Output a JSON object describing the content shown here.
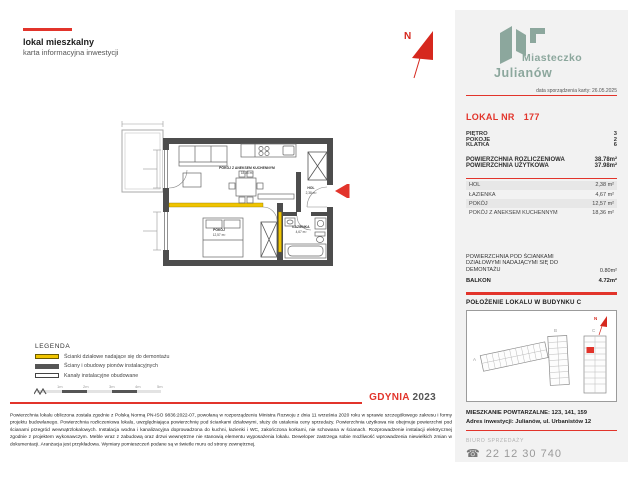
{
  "colors": {
    "accent_red": "#e2342b",
    "logo_green": "#8ca79d",
    "demountable_yellow": "#f0c400",
    "wall_gray": "#4d4d4d",
    "panel_bg": "#f2f2f2"
  },
  "header": {
    "title": "lokal mieszkalny",
    "subtitle": "karta informacyjna inwestycji"
  },
  "compass": {
    "n": "N"
  },
  "plan": {
    "rooms": {
      "living": {
        "name": "POKÓJ Z ANEKSEM KUCHENNYM",
        "area": "18,36 m²"
      },
      "hall": {
        "name": "HOL",
        "area": "2,38 m²"
      },
      "bedroom": {
        "name": "POKÓJ",
        "area": "12,57 m²"
      },
      "bathroom": {
        "name": "ŁAZIENKA",
        "area": "4,67 m²"
      }
    }
  },
  "legend": {
    "title": "LEGENDA",
    "items": [
      {
        "label": "Ścianki działowe nadające się do demontażu",
        "swatch": "#f0c400"
      },
      {
        "label": "Ściany i obudowy pionów instalacyjnych",
        "swatch": "#555555"
      },
      {
        "label": "Kanały instalacyjne obudowane",
        "swatch": "#ffffff"
      }
    ],
    "scale_ticks": [
      "1m",
      "2m",
      "3m",
      "4m",
      "5m"
    ]
  },
  "footer_left": {
    "city": "GDYNIA",
    "year": "2023",
    "disclaimer": "Powierzchnia lokalu obliczona została zgodnie z Polską Normą PN-ISO 9836:2022-07, powołaną w rozporządzeniu Ministra Rozwoju z dnia 11 września 2020 roku w sprawie szczegółowego zakresu i formy projektu budowlanego. Powierzchnia rozliczeniowa lokalu, uwzględniająca powierzchnię pod ściankami działowymi, służy do ustalenia ceny sprzedaży. Powierzchnia użytkowa nie obejmuje powierzchni pod ścianami przegród wewnątrzlokalowych. Instalacja wodna i kanalizacyjna doprowadzona do kuchni, łazienki i WC, zakończona korkami, nie schowana w ścianach. Rozprowadzenie instalacji elektrycznej zgodnie z projektem wykonawczym. Meble wraz z zabudową oraz drzwi wewnętrzne nie stanowią elementu wyposażenia lokalu. Deweloper zastrzega sobie możliwość wprowadzenia niewielkich zmian w dokumentacji. Aranżacja jest przykładowa. Wymiary pomieszczeń podane są w świetle muru od strony zewnętrznej."
  },
  "panel": {
    "logo": {
      "line1": "Miasteczko",
      "line2": "Julianów"
    },
    "date_label": "data sporządzenia karty: 26.05.2025",
    "lokal_label": "LOKAL NR",
    "lokal_number": "177",
    "attrs": [
      {
        "label": "PIĘTRO",
        "value": "3"
      },
      {
        "label": "POKOJE",
        "value": "2"
      },
      {
        "label": "KLATKA",
        "value": "6"
      }
    ],
    "areas": [
      {
        "label": "POWIERZCHNIA ROZLICZENIOWA",
        "value": "38.78m²"
      },
      {
        "label": "POWIERZCHNIA UŻYTKOWA",
        "value": "37.98m²"
      }
    ],
    "room_rows": [
      {
        "label": "HOL",
        "value": "2,38 m²"
      },
      {
        "label": "ŁAZIENKA",
        "value": "4,67 m²"
      },
      {
        "label": "POKÓJ",
        "value": "12,57 m²"
      },
      {
        "label": "POKÓJ Z ANEKSEM KUCHENNYM",
        "value": "18,36 m²"
      }
    ],
    "partition_row": {
      "label": "POWIERZCHNIA POD ŚCIANKAMI DZIAŁOWYMI NADAJĄCYMI SIĘ DO DEMONTAŻU",
      "value": "0.80m²"
    },
    "balcony_row": {
      "label": "BALKON",
      "value": "4.72m²"
    },
    "location_title": "POŁOŻENIE LOKALU W BUDYNKU C",
    "buildings": [
      "A",
      "B",
      "C"
    ],
    "repeat_info": "MIESZKANIE POWTARZALNE: 123, 141, 159",
    "address": "Adres inwestycji: Julianów, ul. Urbanistów 12",
    "office_label": "BIURO SPRZEDAŻY",
    "phone": "22 12 30 740",
    "phone_icon": "☎"
  }
}
